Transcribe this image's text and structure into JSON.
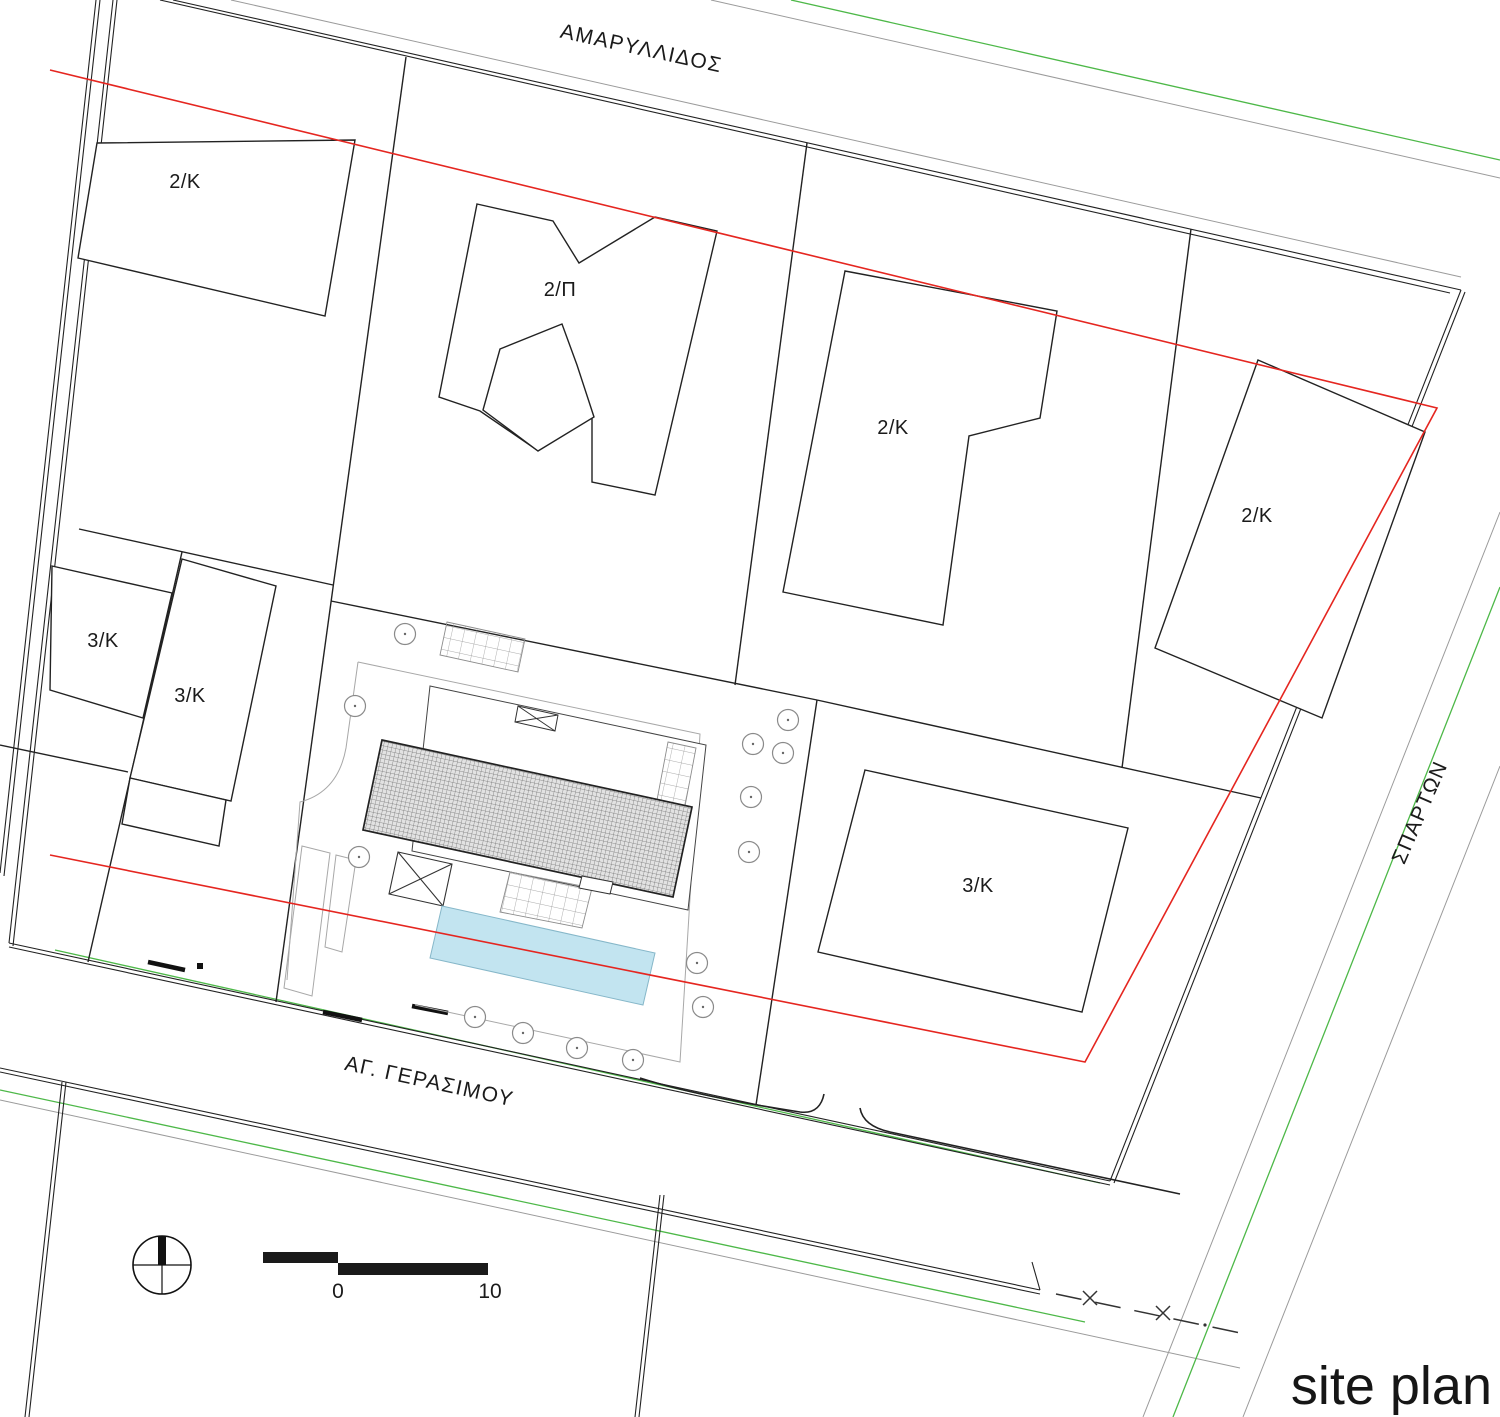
{
  "title": "site plan",
  "streets": {
    "top": "ΑΜΑΡΥΛΛΙΔΟΣ",
    "right": "ΣΠΑΡΤΩΝ",
    "bottom": "ΑΓ. ΓΕΡΑΣΙΜΟΥ"
  },
  "parcel_labels": {
    "top_left": "2/K",
    "top_center": "2/Π",
    "center": "2/K",
    "right": "2/K",
    "left_upper": "3/K",
    "left_lower": "3/K",
    "south": "3/K"
  },
  "scale_bar": {
    "start": "0",
    "end": "10"
  },
  "colors": {
    "boundary_red": "#e52620",
    "street_green": "#4db848",
    "pool_fill": "#c2e4f0",
    "line_black": "#1f1f1f",
    "line_gray": "#9b9b9b"
  }
}
